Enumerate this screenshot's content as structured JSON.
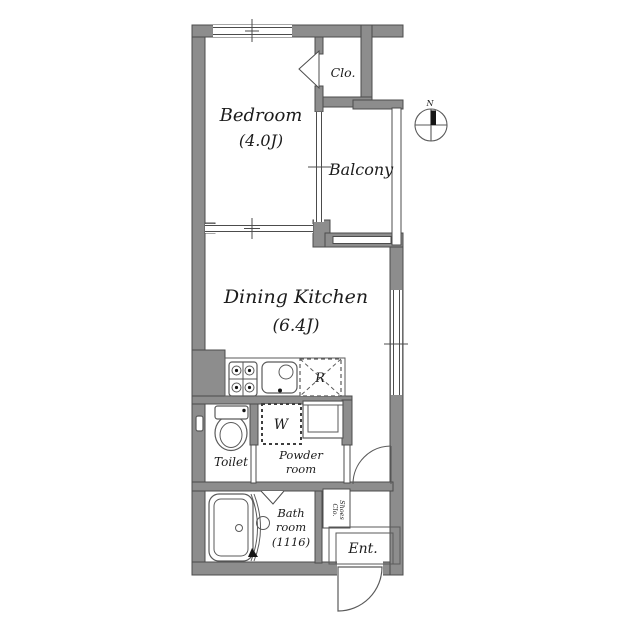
{
  "rooms": {
    "bedroom": {
      "name": "Bedroom",
      "size": "(4.0J)"
    },
    "dining_kitchen": {
      "name": "Dining Kitchen",
      "size": "(6.4J)"
    },
    "closet": {
      "name": "Clo."
    },
    "balcony": {
      "name": "Balcony"
    },
    "toilet": {
      "name": "Toilet"
    },
    "powder_room": {
      "line1": "Powder",
      "line2": "room"
    },
    "bath_room": {
      "line1": "Bath",
      "line2": "room",
      "line3": "(1116)"
    },
    "shoes_closet": {
      "line1": "Shoes",
      "line2": "Clo."
    },
    "entrance": {
      "name": "Ent."
    }
  },
  "fixtures": {
    "refrigerator": "R",
    "washing_machine": "W"
  },
  "compass": {
    "north": "N"
  },
  "colors": {
    "wall": "#8d8d8d",
    "line": "#4c4c4c",
    "fixture_line": "#5a5a5a",
    "text": "#1c1c1c",
    "background": "#ffffff"
  }
}
